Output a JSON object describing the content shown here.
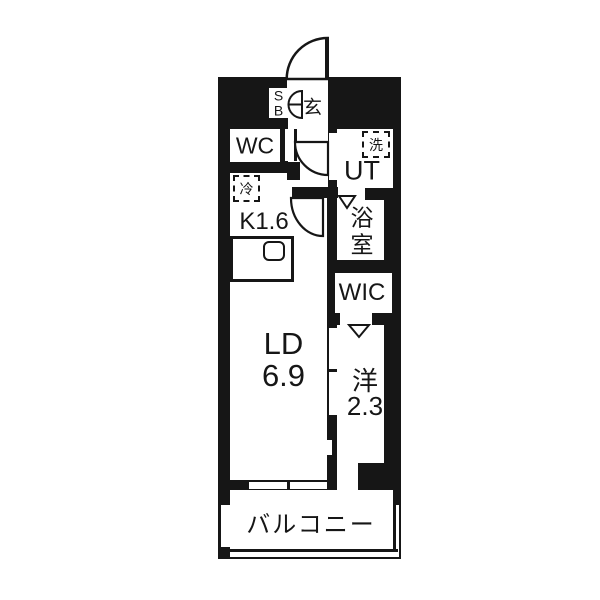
{
  "title": "1K apartment floor plan",
  "colors": {
    "wall": "#161616",
    "floor": "#ffffff"
  },
  "rooms": {
    "shoe_box": {
      "l1": "S",
      "l2": "B"
    },
    "entrance": "玄",
    "wc": "WC",
    "washer": "洗",
    "ut": "UT",
    "fridge": "冷",
    "kitchen": "K1.6",
    "bath": {
      "l1": "浴",
      "l2": "室"
    },
    "wic": "WIC",
    "ld": {
      "l1": "LD",
      "l2": "6.9"
    },
    "western": {
      "l1": "洋",
      "l2": "2.3"
    },
    "balcony": "バルコニー"
  }
}
